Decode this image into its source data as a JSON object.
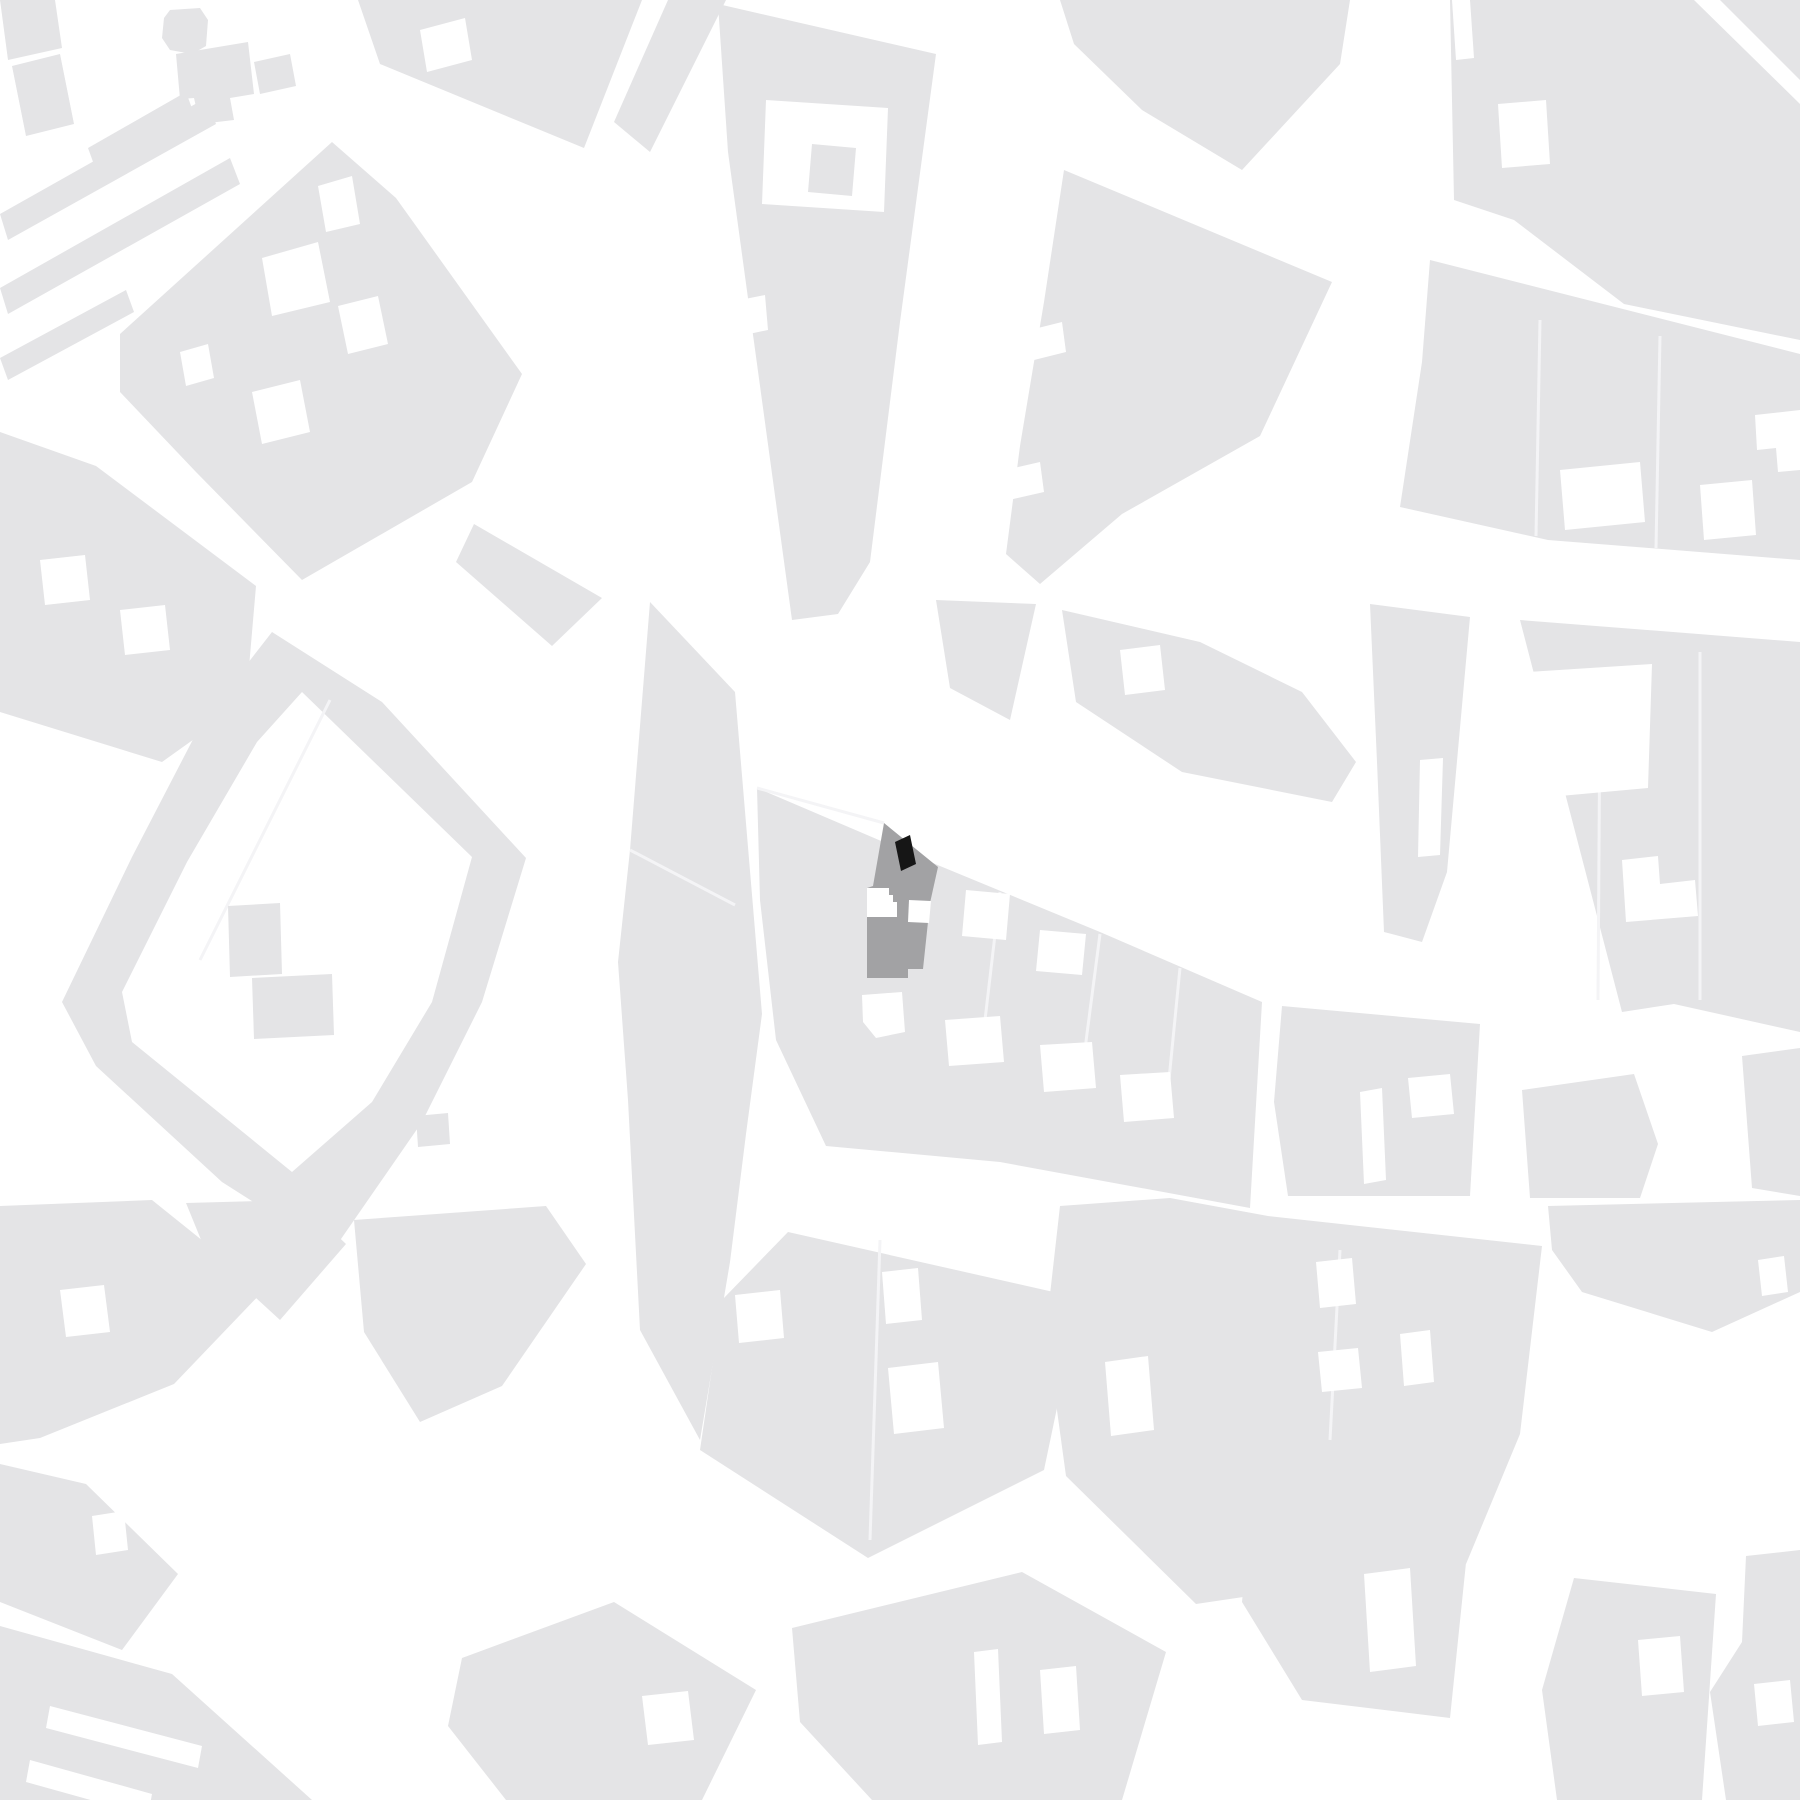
{
  "page": {
    "title": "Figure-ground site plan",
    "type": "architectural location map",
    "scale_text": "",
    "visible_text": "none"
  },
  "map": {
    "width": 1800,
    "height": 1800,
    "colors": {
      "street": "#ffffff",
      "block": "#e4e4e6",
      "courtyard": "#ffffff",
      "division_line": "#f4f4f6",
      "site_parcel": "#a2a2a4",
      "site_building": "#161616"
    },
    "site": {
      "parcel_name": "highlighted-site-parcel",
      "building_name": "site-building-footprint",
      "parcel_points": "884,823 938,867 930,903 923,969 908,969 908,978 867,978 867,888 873,886",
      "building_points": "895,842 910,835 916,864 901,871",
      "notches": [
        {
          "name": "site-courtyard-left",
          "points": "867,888 889,888 889,895 893,895 893,902 897,902 897,917 867,917"
        },
        {
          "name": "site-courtyard-right",
          "points": "909,900 931,901 929,923 908,922"
        }
      ]
    },
    "blocks": [
      {
        "name": "corner-block-a",
        "points": "0,0 55,0 62,48 8,60"
      },
      {
        "name": "corner-block-b",
        "points": "12,66 60,54 74,124 26,136"
      },
      {
        "name": "median-strip-1",
        "points": "0,214 206,98 216,124 8,240"
      },
      {
        "name": "median-strip-2",
        "points": "0,288 230,158 240,184 8,314"
      },
      {
        "name": "median-strip-3",
        "points": "0,358 126,290 134,312 8,380"
      },
      {
        "name": "median-bar",
        "points": "88,148 186,92 194,114 96,170"
      },
      {
        "name": "octagon-building",
        "points": "170,10 200,8 208,20 206,46 192,54 170,50 162,38 164,18"
      },
      {
        "name": "l-building",
        "points": "176,54 248,42 254,94 230,98 234,120 200,124 194,98 180,99"
      },
      {
        "name": "small-building",
        "points": "254,62 290,54 296,86 260,94"
      },
      {
        "name": "block-nw-diamond",
        "points": "120,334 332,142 396,198 522,374 472,482 302,580 196,472 120,392"
      },
      {
        "name": "block-top-center",
        "points": "358,0 642,0 584,148 380,64"
      },
      {
        "name": "block-top-wedge",
        "points": "668,0 726,0 650,152 614,122"
      },
      {
        "name": "block-long-wedge",
        "points": "718,4 936,54 900,322 870,562 838,614 792,620 754,342 728,152"
      },
      {
        "name": "block-ne-wedge",
        "points": "1064,170 1332,282 1260,436 1122,514 1040,584 1006,554 1020,446 1044,302"
      },
      {
        "name": "block-top-ne",
        "points": "1060,0 1350,0 1340,64 1242,170 1142,110 1074,44"
      },
      {
        "name": "block-top-right",
        "points": "1450,0 1694,0 1800,104 1800,340 1624,304 1514,220 1454,200"
      },
      {
        "name": "block-corner-triangle",
        "points": "1720,0 1800,0 1800,80"
      },
      {
        "name": "block-right-middle",
        "points": "1430,260 1800,354 1800,560 1548,540 1400,507 1422,362"
      },
      {
        "name": "block-n1",
        "points": "936,600 1036,604 1010,720 950,688"
      },
      {
        "name": "block-n2",
        "points": "1062,610 1200,642 1302,692 1356,762 1332,802 1182,772 1076,702"
      },
      {
        "name": "block-d1-strip",
        "points": "1370,604 1470,617 1447,872 1422,942 1384,932 1377,762"
      },
      {
        "name": "block-pentagon",
        "points": "1520,620 1800,642 1800,1032 1674,1004 1622,1012"
      },
      {
        "name": "palace-ring",
        "ring": true,
        "points": "272,632 382,702 526,858 482,1002 422,1122 332,1252 222,1182 96,1066 62,1002 132,857 202,722",
        "inner_points": "302,692 472,857 432,1002 372,1102 292,1172 132,1042 122,992 187,862 257,742"
      },
      {
        "name": "block-q1-west",
        "points": "0,432 96,466 256,586 246,702 162,762 0,712"
      },
      {
        "name": "block-m1",
        "points": "474,524 602,598 552,646 456,562"
      },
      {
        "name": "block-h1",
        "points": "650,602 735,692 762,1014 746,1134 730,1262 700,1440 640,1330 628,1100 618,962 630,850"
      },
      {
        "name": "site-block",
        "points": "757,788 940,866 1100,932 1262,1002 1250,1208 1000,1162 826,1146 776,1040 760,900"
      },
      {
        "name": "block-g1-south",
        "points": "788,1232 1080,1298 1044,1470 868,1558 700,1450 722,1300"
      },
      {
        "name": "block-e1",
        "points": "1060,1206 1170,1198 1268,1216 1542,1246 1520,1434 1466,1564 1196,1604 1066,1476 1046,1330"
      },
      {
        "name": "block-d4",
        "points": "1282,1006 1480,1024 1470,1196 1288,1196 1274,1102"
      },
      {
        "name": "block-d5",
        "points": "1522,1090 1634,1074 1658,1144 1640,1198 1530,1198"
      },
      {
        "name": "block-d-corner",
        "points": "1742,1056 1800,1048 1800,1196 1752,1188"
      },
      {
        "name": "block-d6-strip",
        "points": "1548,1206 1800,1200 1800,1292 1712,1332 1582,1292 1552,1250"
      },
      {
        "name": "block-e2",
        "points": "1252,1500 1470,1524 1450,1718 1302,1700 1242,1602"
      },
      {
        "name": "block-e3",
        "points": "1574,1578 1716,1594 1702,1800 1557,1800 1542,1690"
      },
      {
        "name": "block-e4",
        "points": "1746,1556 1800,1550 1800,1800 1726,1800 1710,1692 1742,1642"
      },
      {
        "name": "block-f1",
        "points": "0,1206 152,1200 264,1290 174,1384 40,1438 0,1444"
      },
      {
        "name": "block-f2",
        "points": "186,1203 300,1200 346,1244 280,1320 206,1252"
      },
      {
        "name": "block-w1",
        "points": "354,1220 546,1206 586,1264 502,1386 420,1422 364,1332"
      },
      {
        "name": "block-f3",
        "points": "0,1464 86,1484 178,1574 122,1650 0,1602"
      },
      {
        "name": "block-f4",
        "points": "0,1626 172,1674 312,1800 0,1800"
      },
      {
        "name": "block-g2",
        "points": "462,1658 614,1602 756,1690 702,1800 506,1800 448,1726"
      },
      {
        "name": "block-g3",
        "points": "792,1628 1022,1572 1166,1652 1122,1800 872,1800 800,1722"
      }
    ],
    "courtyards": [
      {
        "name": "courtyard",
        "points": "318,186 352,176 360,224 326,232"
      },
      {
        "name": "courtyard",
        "points": "262,258 318,242 330,302 272,316"
      },
      {
        "name": "courtyard",
        "points": "338,306 378,296 388,344 348,354"
      },
      {
        "name": "courtyard",
        "points": "252,392 300,380 310,432 262,444"
      },
      {
        "name": "courtyard",
        "points": "180,352 208,344 214,378 186,386"
      },
      {
        "name": "courtyard",
        "points": "420,30 465,18 472,60 427,72"
      },
      {
        "name": "courtyard",
        "points": "766,100 888,108 884,212 762,204"
      },
      {
        "name": "courtyard",
        "points": "740,300 765,295 768,330 744,335"
      },
      {
        "name": "courtyard",
        "points": "1030,330 1062,322 1066,352 1034,360"
      },
      {
        "name": "courtyard",
        "points": "1005,470 1040,462 1044,492 1009,500"
      },
      {
        "name": "courtyard",
        "points": "1498,104 1546,100 1550,164 1502,168"
      },
      {
        "name": "courtyard",
        "points": "1452,0 1470,0 1474,58 1456,60"
      },
      {
        "name": "courtyard",
        "points": "1560,470 1640,462 1645,522 1565,530"
      },
      {
        "name": "courtyard",
        "points": "1700,485 1752,480 1756,535 1704,540"
      },
      {
        "name": "courtyard",
        "points": "1755,415 1800,410 1800,470 1778,472 1776,448 1757,450"
      },
      {
        "name": "courtyard",
        "points": "1120,650 1160,645 1165,690 1125,695"
      },
      {
        "name": "courtyard",
        "points": "1420,760 1443,758 1440,855 1418,857"
      },
      {
        "name": "courtyard",
        "points": "1528,672 1652,664 1648,788 1560,796 1552,760 1535,756"
      },
      {
        "name": "courtyard",
        "points": "1622,860 1658,856 1660,884 1695,880 1698,916 1626,922"
      },
      {
        "name": "courtyard",
        "points": "40,560 85,555 90,600 45,605"
      },
      {
        "name": "courtyard",
        "points": "120,610 165,605 170,650 125,655"
      },
      {
        "name": "courtyard",
        "points": "966,890 1010,894 1006,940 962,936"
      },
      {
        "name": "courtyard",
        "points": "1040,930 1086,934 1082,975 1036,971"
      },
      {
        "name": "courtyard",
        "points": "862,995 902,992 905,1032 876,1038 863,1022"
      },
      {
        "name": "courtyard",
        "points": "945,1020 1000,1016 1004,1062 949,1066"
      },
      {
        "name": "courtyard",
        "points": "1040,1045 1092,1042 1096,1088 1044,1092"
      },
      {
        "name": "courtyard",
        "points": "1120,1075 1170,1072 1174,1118 1124,1122"
      },
      {
        "name": "courtyard",
        "points": "882,1272 918,1268 922,1320 886,1324"
      },
      {
        "name": "courtyard",
        "points": "735,1295 780,1290 784,1338 739,1343"
      },
      {
        "name": "courtyard",
        "points": "888,1368 938,1362 944,1428 894,1434"
      },
      {
        "name": "courtyard",
        "points": "1105,1362 1148,1356 1154,1430 1111,1436"
      },
      {
        "name": "courtyard",
        "points": "1316,1262 1352,1258 1356,1304 1320,1308"
      },
      {
        "name": "courtyard",
        "points": "1318,1352 1358,1348 1362,1388 1322,1392"
      },
      {
        "name": "courtyard",
        "points": "1400,1334 1430,1330 1434,1382 1404,1386"
      },
      {
        "name": "courtyard",
        "points": "1360,1092 1382,1088 1386,1180 1364,1184"
      },
      {
        "name": "courtyard",
        "points": "1408,1078 1450,1074 1454,1114 1412,1118"
      },
      {
        "name": "courtyard",
        "points": "1758,1260 1784,1256 1788,1292 1762,1296"
      },
      {
        "name": "courtyard",
        "points": "1364,1574 1410,1568 1416,1666 1370,1672"
      },
      {
        "name": "courtyard",
        "points": "1638,1640 1680,1636 1684,1692 1642,1696"
      },
      {
        "name": "courtyard",
        "points": "1754,1684 1790,1680 1794,1722 1758,1726"
      },
      {
        "name": "courtyard",
        "points": "60,1290 104,1285 110,1332 66,1337"
      },
      {
        "name": "courtyard",
        "points": "92,1516 124,1511 128,1550 96,1555"
      },
      {
        "name": "courtyard",
        "points": "50,1706 202,1746 198,1768 46,1728"
      },
      {
        "name": "courtyard",
        "points": "30,1760 152,1794 148,1816 26,1782"
      },
      {
        "name": "courtyard",
        "points": "642,1696 688,1691 694,1740 648,1745"
      },
      {
        "name": "courtyard",
        "points": "974,1652 998,1649 1002,1742 978,1745"
      },
      {
        "name": "courtyard",
        "points": "1040,1670 1076,1666 1080,1730 1044,1734"
      }
    ],
    "inner_buildings": [
      {
        "name": "courtyard-building",
        "points": "812,144 856,148 852,196 808,192"
      },
      {
        "name": "courtyard-building",
        "points": "228,906 280,903 282,974 230,977"
      },
      {
        "name": "courtyard-building",
        "points": "252,978 332,974 334,1035 254,1039"
      },
      {
        "name": "courtyard-building",
        "points": "416,1116 448,1113 450,1144 418,1147"
      }
    ],
    "division_lines": [
      {
        "name": "parcel-line",
        "points": "884,823 757,788"
      },
      {
        "name": "parcel-line",
        "points": "1000,892 985,1020"
      },
      {
        "name": "parcel-line",
        "points": "1100,934 1082,1072"
      },
      {
        "name": "parcel-line",
        "points": "1180,968 1166,1110"
      },
      {
        "name": "parcel-line",
        "points": "630,850 735,905"
      },
      {
        "name": "parcel-line",
        "points": "1540,320 1536,536"
      },
      {
        "name": "parcel-line",
        "points": "1660,336 1656,548"
      },
      {
        "name": "parcel-line",
        "points": "1600,700 1598,1000"
      },
      {
        "name": "parcel-line",
        "points": "1700,652 1700,1000"
      },
      {
        "name": "parcel-line",
        "points": "1340,1250 1330,1440"
      },
      {
        "name": "parcel-line",
        "points": "880,1240 870,1540"
      },
      {
        "name": "parcel-line",
        "points": "330,700 200,960"
      }
    ]
  }
}
